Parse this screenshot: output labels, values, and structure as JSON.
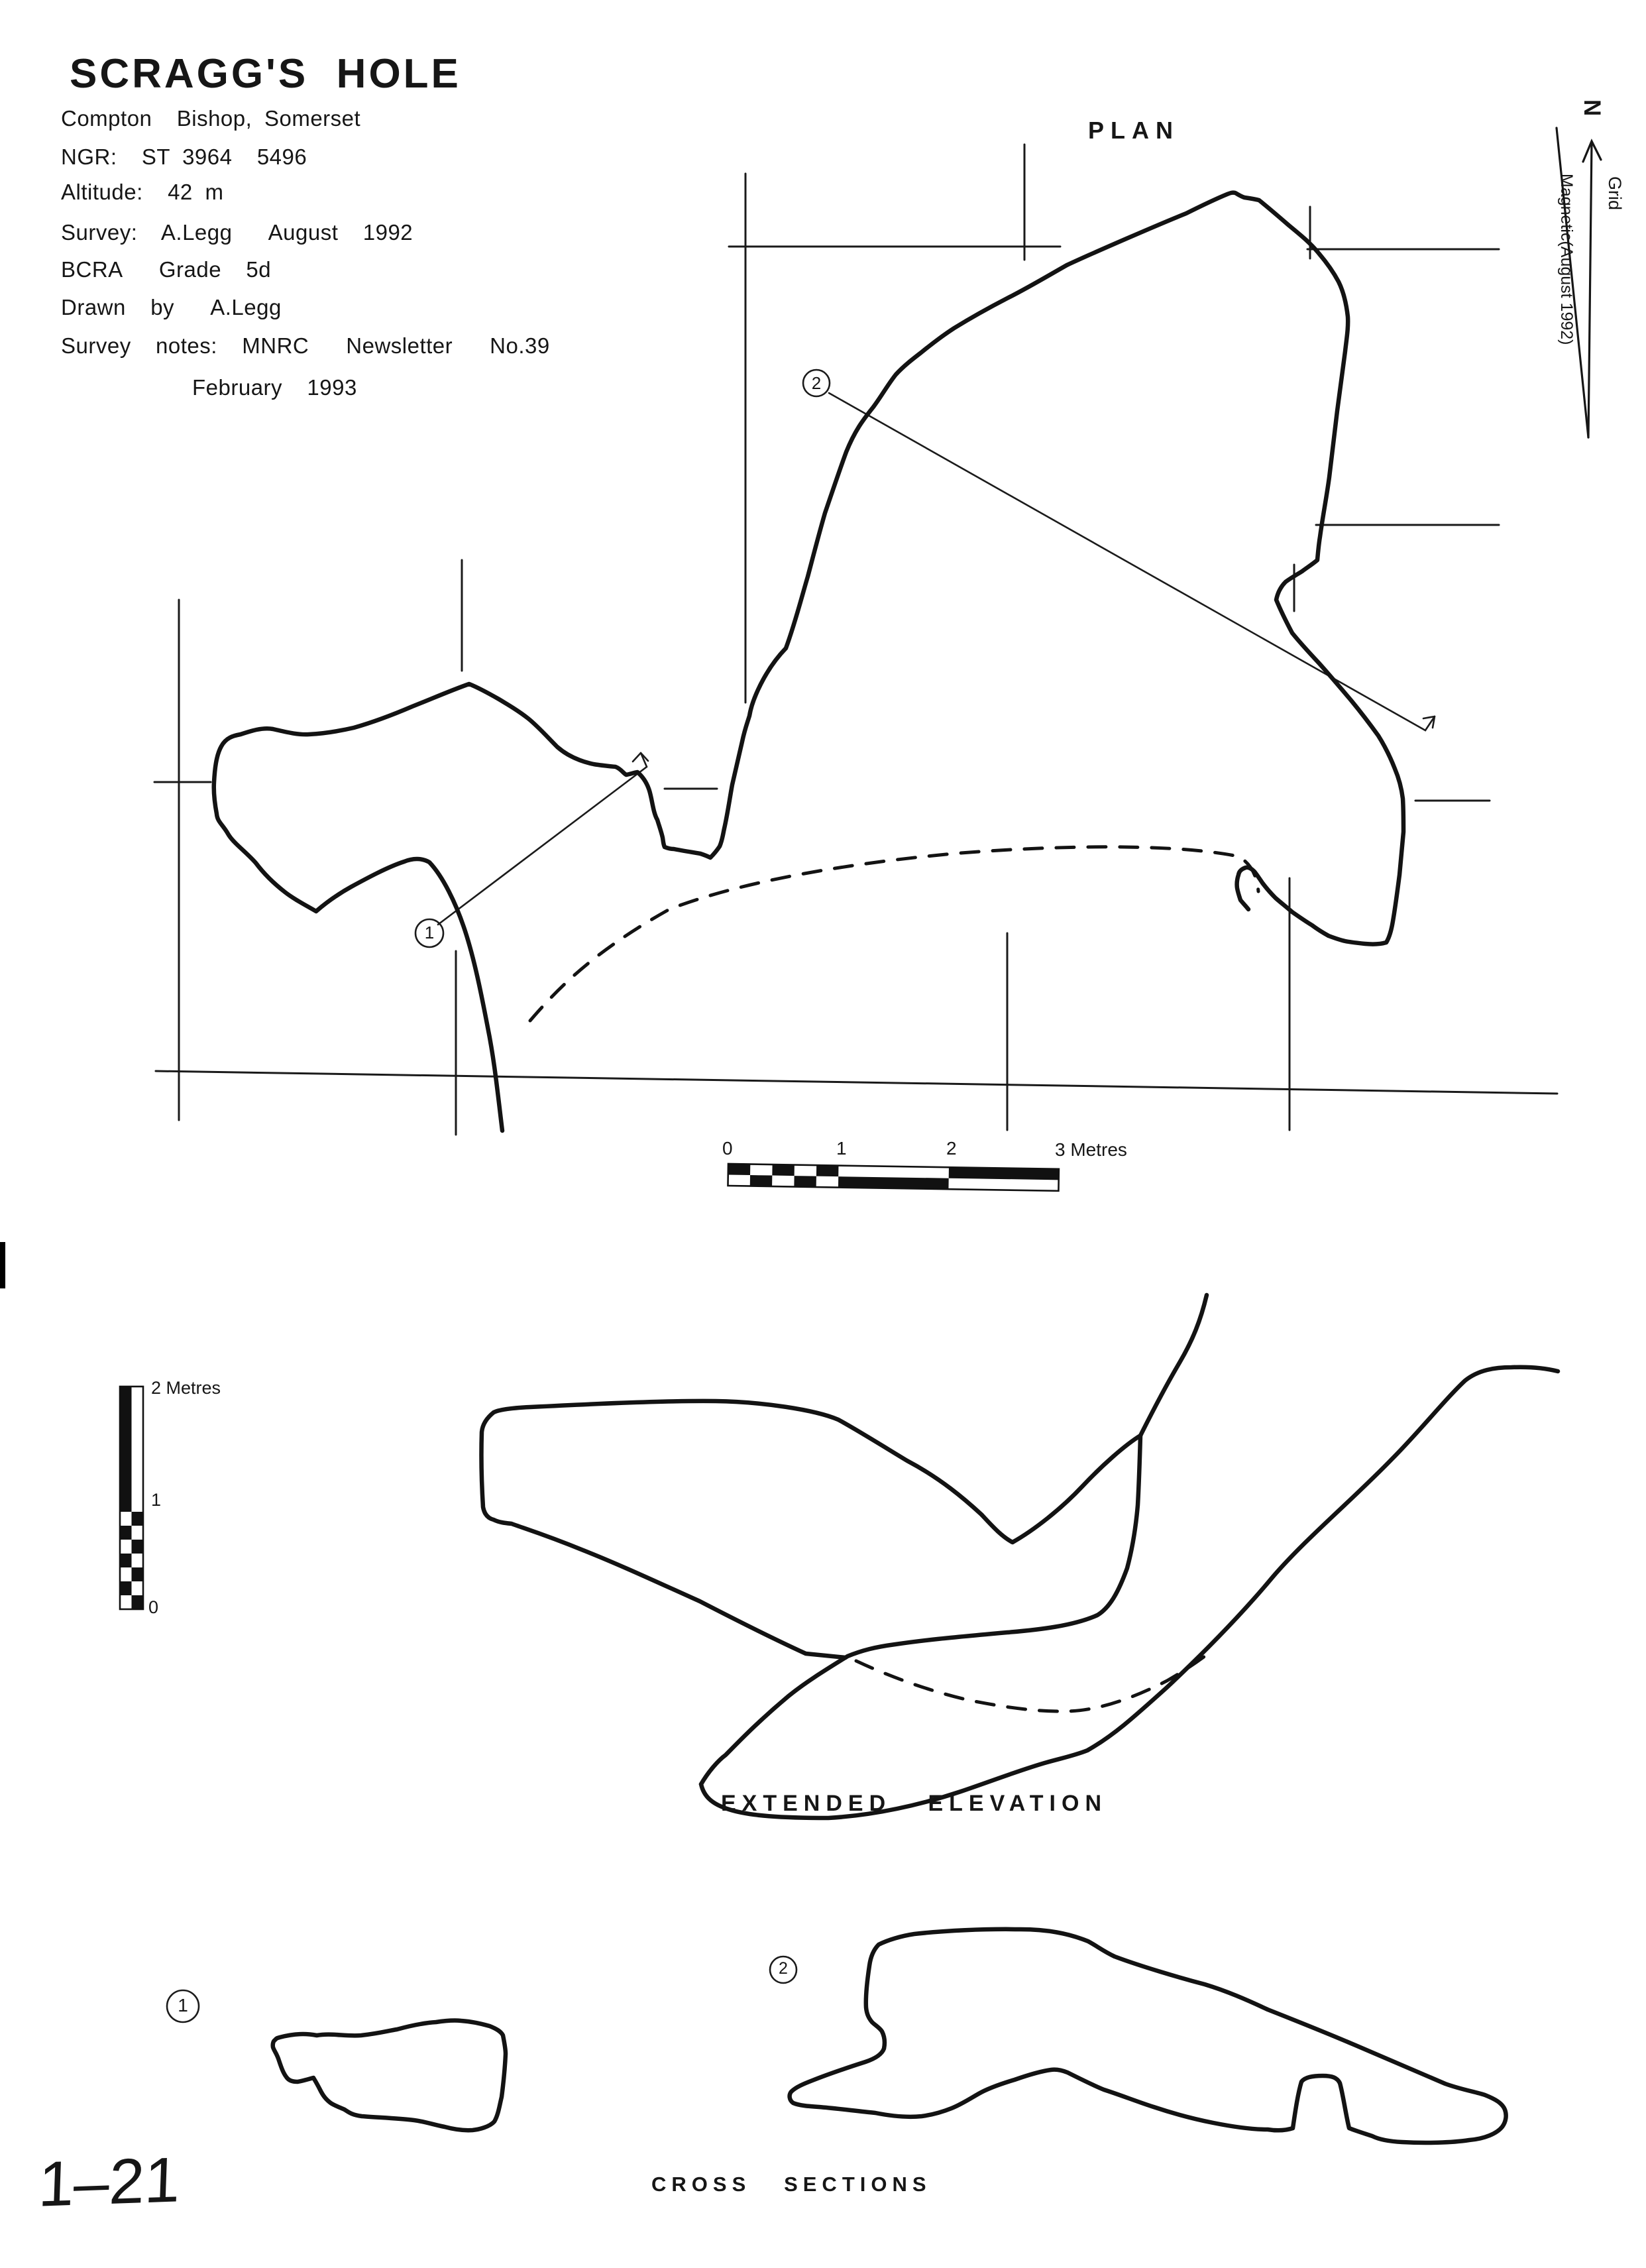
{
  "header": {
    "title": "SCRAGG'S  HOLE",
    "location": "Compton  Bishop, Somerset",
    "ngr": "NGR:  ST 3964  5496",
    "altitude": "Altitude:  42 m",
    "survey": "Survey:  A.Legg   August  1992",
    "grade": "BCRA   Grade  5d",
    "drawn_by": "Drawn  by   A.Legg",
    "notes": "Survey  notes:  MNRC   Newsletter   No.39",
    "notes_date": "February  1993"
  },
  "plan": {
    "label": "PLAN",
    "section_marker_1": "1",
    "section_marker_2": "2"
  },
  "north_indicator": {
    "n_label": "N",
    "grid_label": "Grid",
    "magnetic_label": "Magnetic(August 1992)"
  },
  "plan_scale": {
    "tick_0": "0",
    "tick_1": "1",
    "tick_2": "2",
    "tick_3": "3 Metres"
  },
  "elevation": {
    "label": "EXTENDED   ELEVATION"
  },
  "elevation_scale": {
    "top": "2 Metres",
    "mid": "1",
    "bottom": "0"
  },
  "cross_sections": {
    "label": "CROSS   SECTIONS",
    "section_marker_1": "1",
    "section_marker_2": "2"
  },
  "page_number": "1–21",
  "colors": {
    "ink": "#161616",
    "paper": "#ffffff"
  }
}
